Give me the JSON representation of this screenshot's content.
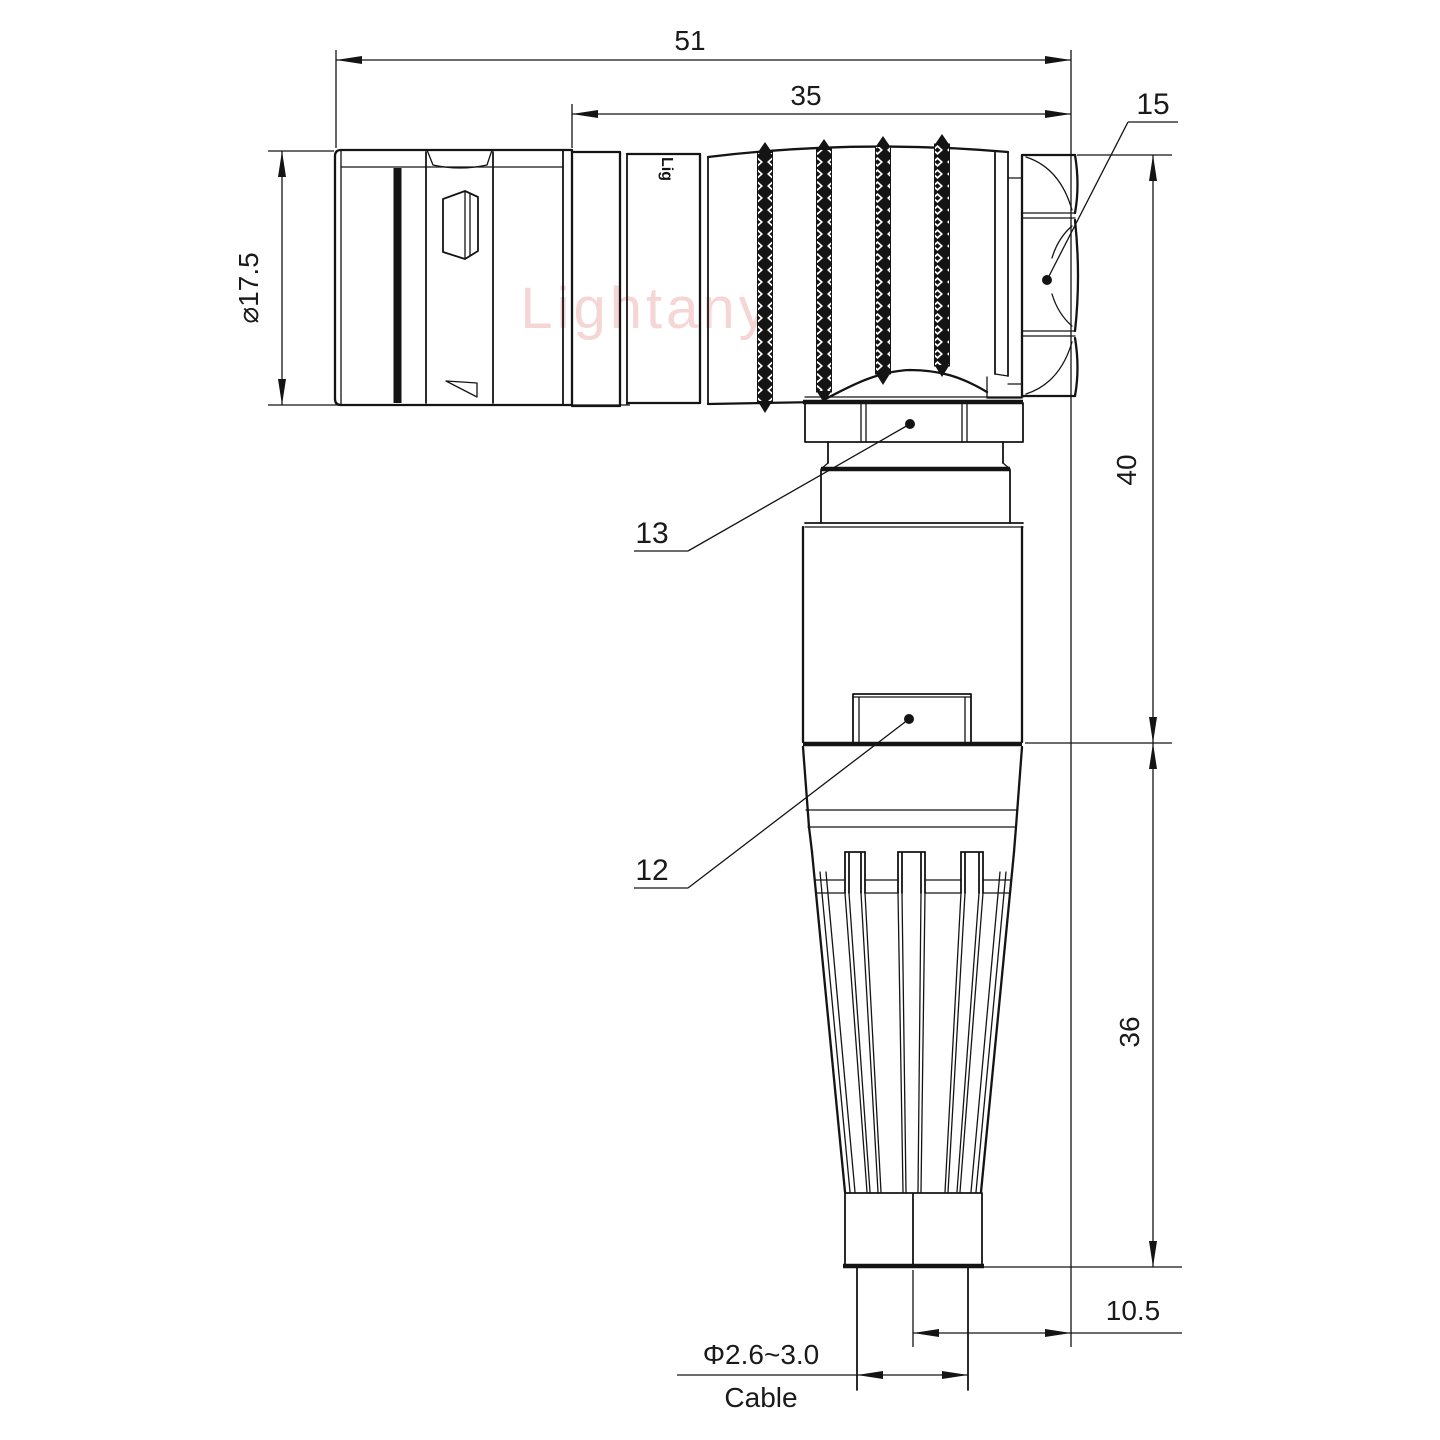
{
  "drawing": {
    "type": "right-angle circular connector technical drawing",
    "watermark": {
      "text": "Lightany",
      "color": "#f0b4b4"
    },
    "engraving": {
      "text": "Lig"
    },
    "dimensions": {
      "overall_length": {
        "label": "51"
      },
      "rear_length": {
        "label": "35"
      },
      "front_diameter": {
        "label": "⌀17.5"
      },
      "height_upper": {
        "label": "40"
      },
      "height_lower": {
        "label": "36"
      },
      "center_offset": {
        "label": "10.5"
      },
      "cable_diameter": {
        "label": "Φ2.6~3.0"
      },
      "cable_word": {
        "label": "Cable"
      }
    },
    "callouts": {
      "hex_nut": {
        "label": "15"
      },
      "coupling_collar": {
        "label": "13"
      },
      "latch": {
        "label": "12"
      }
    },
    "colors": {
      "line": "#141414",
      "watermark_pink": "#f0b4b4",
      "background": "#ffffff"
    }
  }
}
